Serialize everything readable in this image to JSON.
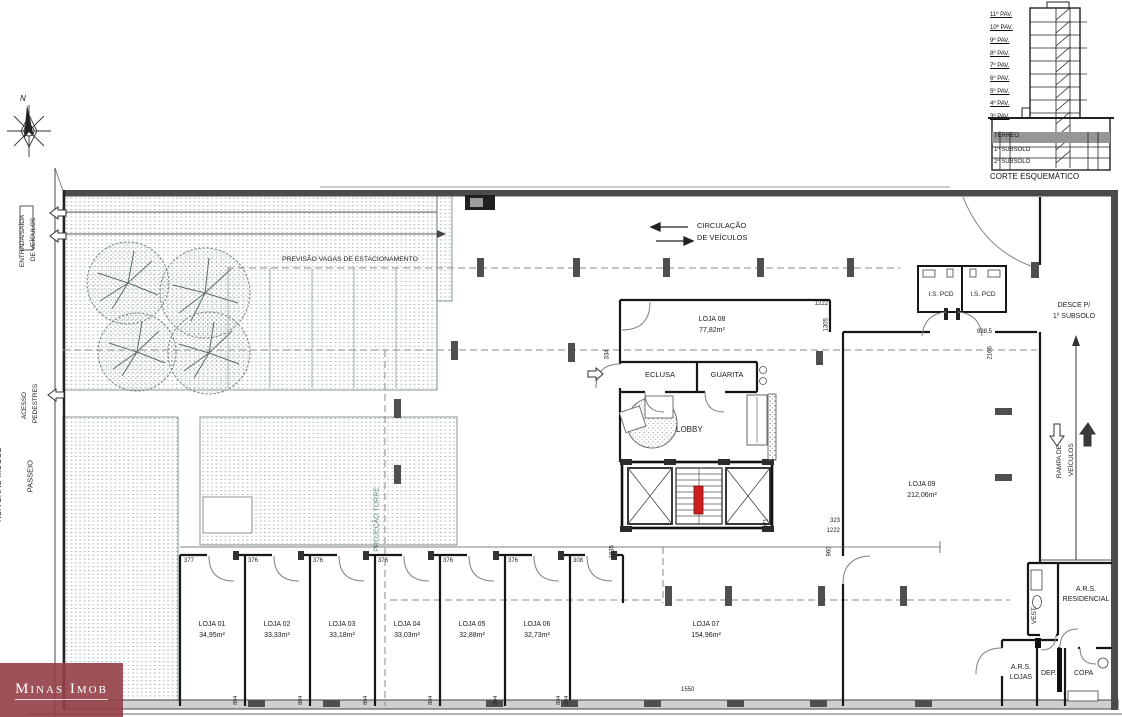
{
  "plan": {
    "compass_n": "N",
    "street": {
      "entrada1": "ENTRADA/SAÍDA",
      "entrada2": "DE VEÍCULOS",
      "acesso1": "ACESSO",
      "acesso2": "PEDESTRES",
      "passeio": "PASSEIO",
      "rua": "RUA GRÃO MOGOL"
    },
    "zones": {
      "estacionamento": "PREVISÃO VAGAS DE ESTACIONAMENTO",
      "circ1": "CIRCULAÇÃO",
      "circ2": "DE VEÍCULOS",
      "projecao": "PROJEÇÃO TORRE",
      "desce1": "DESCE P/",
      "desce2": "1º SUBSOLO",
      "rampa1": "RAMPA DE",
      "rampa2": "VEÍCULOS",
      "lobby": "LOBBY",
      "eclusa": "ECLUSA",
      "guarita": "GUARITA",
      "ispcd": "I.S. PCD",
      "vest": "VEST.",
      "arsres1": "A.R.S.",
      "arsres2": "RESIDENCIAL",
      "arslojas1": "A.R.S.",
      "arslojas2": "LOJAS",
      "dep": "DEP.",
      "copa": "COPA"
    },
    "lojas": [
      {
        "name": "LOJA 01",
        "area": "34,95m²"
      },
      {
        "name": "LOJA 02",
        "area": "33,33m²"
      },
      {
        "name": "LOJA 03",
        "area": "33,18m²"
      },
      {
        "name": "LOJA 04",
        "area": "33,03m²"
      },
      {
        "name": "LOJA 05",
        "area": "32,88m²"
      },
      {
        "name": "LOJA 06",
        "area": "32,73m²"
      },
      {
        "name": "LOJA 07",
        "area": "154,96m²"
      },
      {
        "name": "LOJA 08",
        "area": "77,82m²"
      },
      {
        "name": "LOJA 09",
        "area": "212,06m²"
      }
    ],
    "dims": {
      "top_row": [
        "377",
        "376",
        "376",
        "376",
        "376",
        "376",
        "308"
      ],
      "v804": "804",
      "d1550": "1550",
      "d334": "334",
      "d1222a": "1222",
      "d1305": "1305",
      "d971": "971",
      "d323": "323",
      "d1222b": "1222",
      "d960": "960",
      "d1835": "1835",
      "d9385": "938,5",
      "d2166": "2166"
    }
  },
  "corte": {
    "title": "CORTE ESQUEMÁTICO",
    "floors": [
      "11º PAV.",
      "10º PAV.",
      "9º PAV.",
      "8º PAV.",
      "7º PAV.",
      "6º PAV.",
      "5º PAV.",
      "4º PAV.",
      "3º PAV."
    ],
    "terreo": "TÉRREO",
    "sub1": "1º SUBSOLO",
    "sub2": "2º SUBSOLO"
  },
  "watermark": {
    "text": "Minas Imob"
  }
}
